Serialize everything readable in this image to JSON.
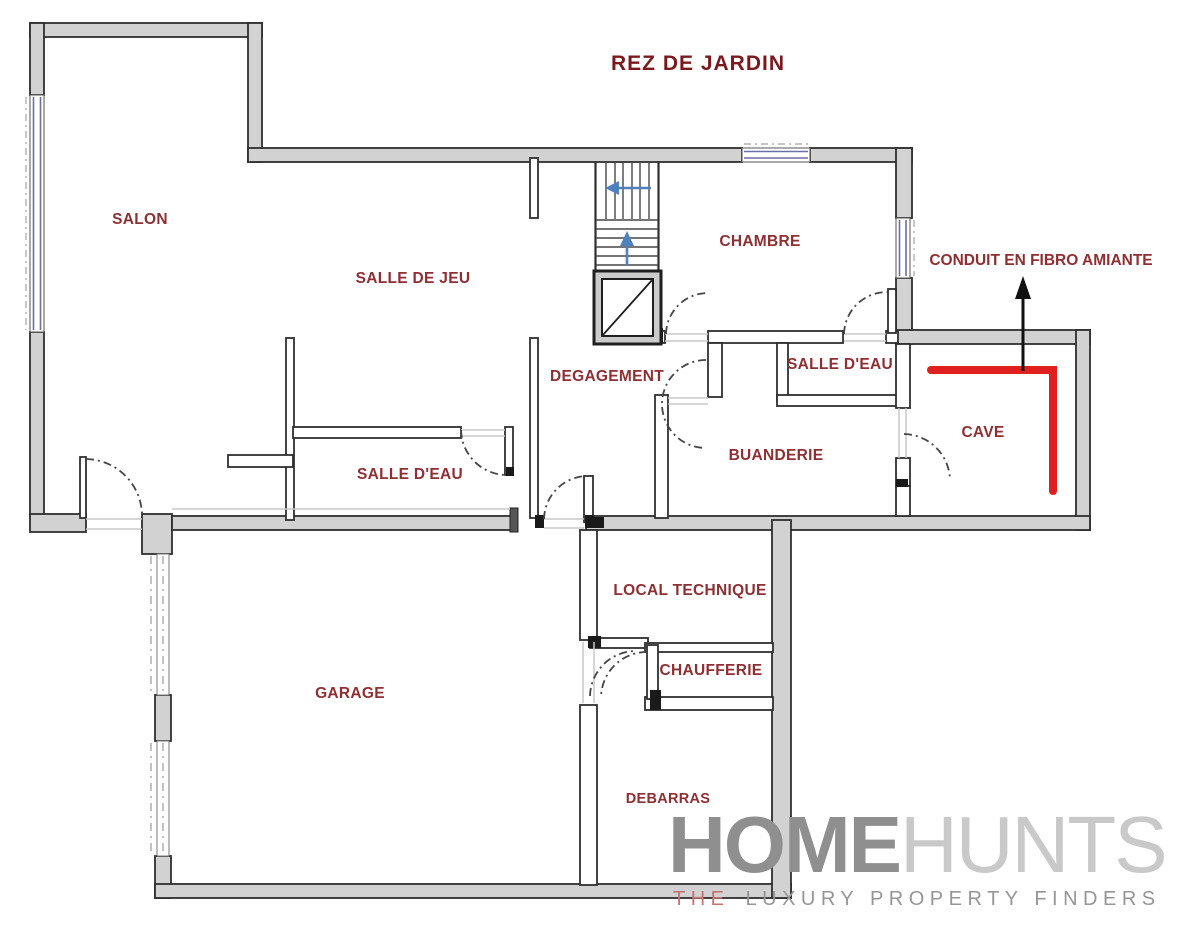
{
  "title": "REZ DE JARDIN",
  "annotation": {
    "conduit_label": "CONDUIT EN FIBRO AMIANTE"
  },
  "rooms": [
    {
      "id": "salon",
      "label": "SALON"
    },
    {
      "id": "salle-de-jeu",
      "label": "SALLE DE JEU"
    },
    {
      "id": "chambre",
      "label": "CHAMBRE"
    },
    {
      "id": "salle-deau-chambre",
      "label": "SALLE D'EAU"
    },
    {
      "id": "degagement",
      "label": "DEGAGEMENT"
    },
    {
      "id": "buanderie",
      "label": "BUANDERIE"
    },
    {
      "id": "cave",
      "label": "CAVE"
    },
    {
      "id": "salle-deau",
      "label": "SALLE D'EAU"
    },
    {
      "id": "garage",
      "label": "GARAGE"
    },
    {
      "id": "local-technique",
      "label": "LOCAL TECHNIQUE"
    },
    {
      "id": "chaufferie",
      "label": "CHAUFFERIE"
    },
    {
      "id": "debarras",
      "label": "DEBARRAS"
    }
  ],
  "logo": {
    "word1": "HOME",
    "word2": "HUNTS",
    "tagline_lead": "THE",
    "tagline_rest": "LUXURY PROPERTY FINDERS"
  },
  "colors": {
    "wall_fill": "#d2d2d2",
    "wall_outline": "#2f2f2f",
    "label_red": "#8e2f33",
    "title_red": "#7a1a1e",
    "conduit_red": "#e01f1f",
    "window_blue": "#6d6da8",
    "stair_arrow_blue": "#4f81bd",
    "annotation_arrow_black": "#111111",
    "logo_home_gray": "#8f8f8f",
    "logo_hunts_gray": "#c9c9c9",
    "logo_the_salmon": "#c4736e",
    "logo_tagline_gray": "#969696"
  }
}
